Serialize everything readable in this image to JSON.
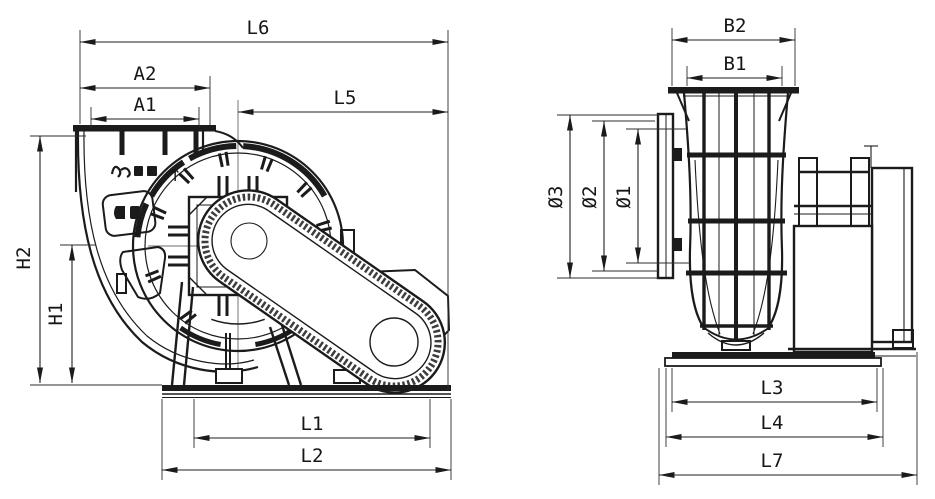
{
  "drawing": {
    "type": "technical-dimension-drawing",
    "subject": "centrifugal fan, two orthographic views",
    "palette": {
      "ink": "#1b1b1b",
      "paper": "#ffffff"
    },
    "left_view": {
      "dims": {
        "L6": "L6",
        "A2": "A2",
        "A1": "A1",
        "L5": "L5",
        "H2": "H2",
        "H1": "H1",
        "L1": "L1",
        "L2": "L2"
      },
      "logo_arrow": "↑"
    },
    "right_view": {
      "dims": {
        "B2": "B2",
        "B1": "B1",
        "D3": "Ø3",
        "D2": "Ø2",
        "D1": "Ø1",
        "L3": "L3",
        "L4": "L4",
        "L7": "L7"
      }
    }
  }
}
